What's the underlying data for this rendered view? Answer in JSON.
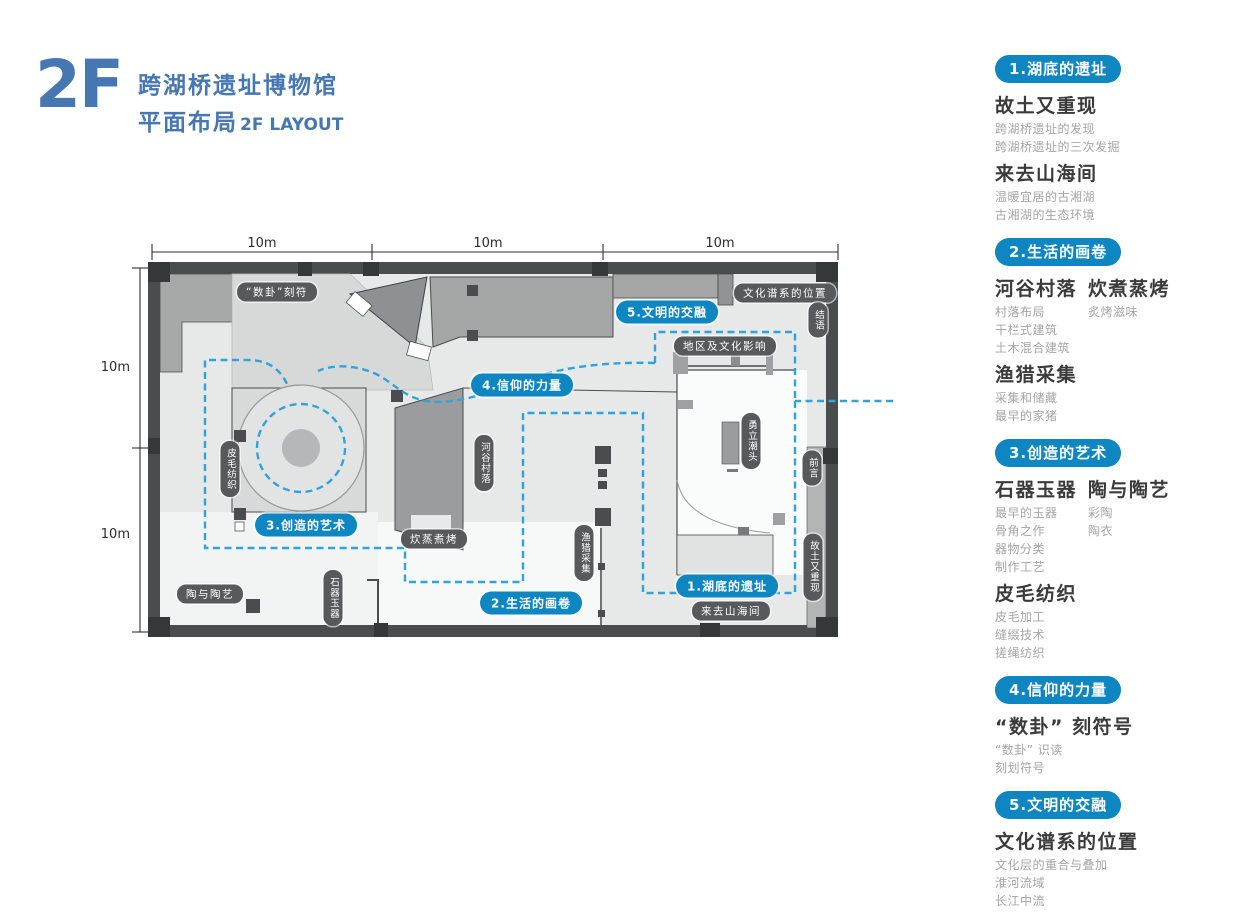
{
  "header": {
    "floor": "2F",
    "museum": "跨湖桥遗址博物馆",
    "subtitle": "平面布局",
    "subtitle_en": "2F LAYOUT"
  },
  "colors": {
    "title_blue": "#4677b2",
    "badge_blue": "#0e86c2",
    "route_blue": "#2ea3dc",
    "pill_dark": "#58595b",
    "wall_dark": "#4a4c4d"
  },
  "plan": {
    "dimensions": {
      "top": [
        "10m",
        "10m",
        "10m"
      ],
      "left": [
        "10m",
        "10m"
      ]
    },
    "labels": [
      {
        "text": "1.湖底的遗址"
      },
      {
        "text": "2.生活的画卷"
      },
      {
        "text": "3.创造的艺术"
      },
      {
        "text": "4.信仰的力量"
      },
      {
        "text": "5.文明的交融"
      },
      {
        "text": "“数卦”刻符"
      },
      {
        "text": "文化谱系的位置"
      },
      {
        "text": "地区及文化影响"
      },
      {
        "text": "炊蒸煮烤"
      },
      {
        "text": "来去山海间"
      },
      {
        "text": "陶与陶艺"
      },
      {
        "text": "河谷村落"
      },
      {
        "text": "渔猎采集"
      },
      {
        "text": "皮毛纺织"
      },
      {
        "text": "石器玉器"
      },
      {
        "text": "勇立潮头"
      },
      {
        "text": "结语"
      },
      {
        "text": "前言"
      },
      {
        "text": "故土又重现"
      }
    ]
  },
  "legend": {
    "sections": [
      {
        "header": "1.湖底的遗址",
        "groups": [
          {
            "title": "故土又重现",
            "items": [
              "跨湖桥遗址的发现",
              "跨湖桥遗址的三次发掘"
            ]
          },
          {
            "title": "来去山海间",
            "items": [
              "温暖宜居的古湘湖",
              "古湘湖的生态环境"
            ]
          }
        ]
      },
      {
        "header": "2.生活的画卷",
        "columns": [
          {
            "title": "河谷村落",
            "items": [
              "村落布局",
              "干栏式建筑",
              "土木混合建筑"
            ]
          },
          {
            "title": "炊煮蒸烤",
            "items": [
              "炙烤滋味"
            ]
          }
        ],
        "groups": [
          {
            "title": "渔猎采集",
            "items": [
              "采集和储藏",
              "最早的家猪"
            ]
          }
        ]
      },
      {
        "header": "3.创造的艺术",
        "columns": [
          {
            "title": "石器玉器",
            "items": [
              "最早的玉器",
              "骨角之作",
              "器物分类",
              "制作工艺"
            ]
          },
          {
            "title": "陶与陶艺",
            "items": [
              "彩陶",
              "陶衣"
            ]
          }
        ],
        "groups": [
          {
            "title": "皮毛纺织",
            "items": [
              "皮毛加工",
              "缝缀技术",
              "搓绳纺织"
            ]
          }
        ]
      },
      {
        "header": "4.信仰的力量",
        "groups": [
          {
            "title": "“数卦” 刻符号",
            "items": [
              "“数卦” 识读",
              "刻划符号"
            ]
          }
        ]
      },
      {
        "header": "5.文明的交融",
        "groups": [
          {
            "title": "文化谱系的位置",
            "items": [
              "文化层的重合与叠加",
              "淮河流域",
              "长江中流"
            ]
          }
        ]
      }
    ]
  }
}
